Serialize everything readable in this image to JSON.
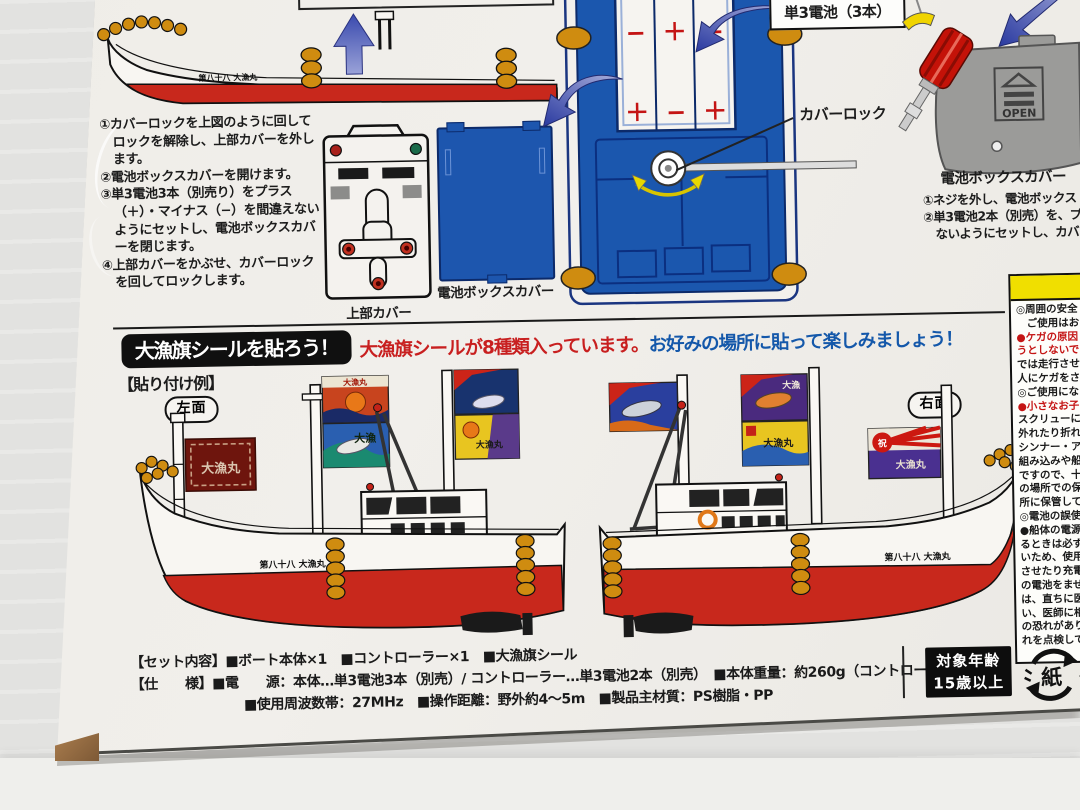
{
  "colors": {
    "boat_blue": "#1b57ae",
    "boat_red": "#c8281c",
    "fender_orange": "#cf8c10",
    "flag_dark_red": "#6e150d",
    "warning_yellow": "#f0df00",
    "note_red": "#c81f1f",
    "note_blue": "#1458aa"
  },
  "top_section": {
    "steps": [
      "①カバーロックを上図のように回してロックを解除し、上部カバーを外します。",
      "②電池ボックスカバーを開けます。",
      "③単3電池3本（別売り）をプラス（＋）・マイナス（−）を間違えないようにセットし、電池ボックスカバーを閉じます。",
      "④上部カバーをかぶせ、カバーロックを回してロックします。"
    ],
    "top_cover_label": "上部カバー",
    "battery_cover_label": "電池ボックスカバー",
    "battery_pack_label": "単3電池（3本）",
    "cover_lock_label": "カバーロック",
    "hull_name": "第八十八 大漁丸",
    "polarity_top": [
      "−",
      "＋",
      "−"
    ],
    "polarity_bottom": [
      "＋",
      "−",
      "＋"
    ]
  },
  "controller_section": {
    "cover_label": "電池ボックスカバー",
    "open_label": "OPEN",
    "steps": [
      "①ネジを外し、電池ボックス",
      "②単3電池2本（別売）を、プ",
      "　ないようにセットし、カバー"
    ]
  },
  "sticker_section": {
    "header": "大漁旗シールを貼ろう！",
    "note_red": "大漁旗シールが8種類入っています。",
    "note_blue": "お好みの場所に貼って楽しみましょう！",
    "example_label": "【貼り付け例】",
    "left_label": "左面",
    "right_label": "右面",
    "bow_flag_text": "大漁丸",
    "flag_text_tairyo": "大漁",
    "flag_text_tairyomaru": "大漁丸",
    "flag_text_celebrate": "祝",
    "hull_name": "第八十八 大漁丸"
  },
  "specs": {
    "line1": "【セット内容】■ボート本体×1　■コントローラー×1　■大漁旗シール",
    "line2": "【仕　　様】■電　　源：本体…単3電池3本（別売）/ コントローラー…単3電池2本（別売）　■本体重量：約260g（コントローラー含む）",
    "line3": "■使用周波数帯：27MHz　■操作距離：野外約4～5m　■製品主材質：PS樹脂・PP"
  },
  "age_badge": {
    "line1": "対象年齢",
    "line2": "15歳以上"
  },
  "recycle_mark": {
    "symbol": "紙",
    "suffix": "ダ"
  },
  "warning_box": {
    "lines": [
      {
        "t": "◎周囲の安全",
        "red": false
      },
      {
        "t": "　ご使用はお",
        "red": false
      },
      {
        "t": "●ケガの原因",
        "red": true
      },
      {
        "t": "うとしないで",
        "red": true
      },
      {
        "t": "では走行させ",
        "red": false
      },
      {
        "t": "人にケガをさ",
        "red": false
      },
      {
        "t": "◎ご使用にな",
        "red": false
      },
      {
        "t": "●小さなお子",
        "red": true
      },
      {
        "t": "スクリューに指",
        "red": false
      },
      {
        "t": "外れたり折れた",
        "red": false
      },
      {
        "t": "シンナー・アル",
        "red": false
      },
      {
        "t": "組み込みや船体",
        "red": false
      },
      {
        "t": "ですので、十分",
        "red": false
      },
      {
        "t": "の場所での保管",
        "red": false
      },
      {
        "t": "所に保管してく",
        "red": false
      },
      {
        "t": "◎電池の誤使用",
        "red": false
      },
      {
        "t": "●船体の電源を",
        "red": false
      },
      {
        "t": "るときは必ず電",
        "red": false
      },
      {
        "t": "いため、使用し",
        "red": false
      },
      {
        "t": "させたり充電、分",
        "red": false
      },
      {
        "t": "の電池をまぜて",
        "red": false
      },
      {
        "t": "は、直ちに医師",
        "red": false
      },
      {
        "t": "い、医師に相談",
        "red": false
      },
      {
        "t": "の恐れがありま",
        "red": false
      },
      {
        "t": "れを点検してく",
        "red": false
      }
    ]
  }
}
